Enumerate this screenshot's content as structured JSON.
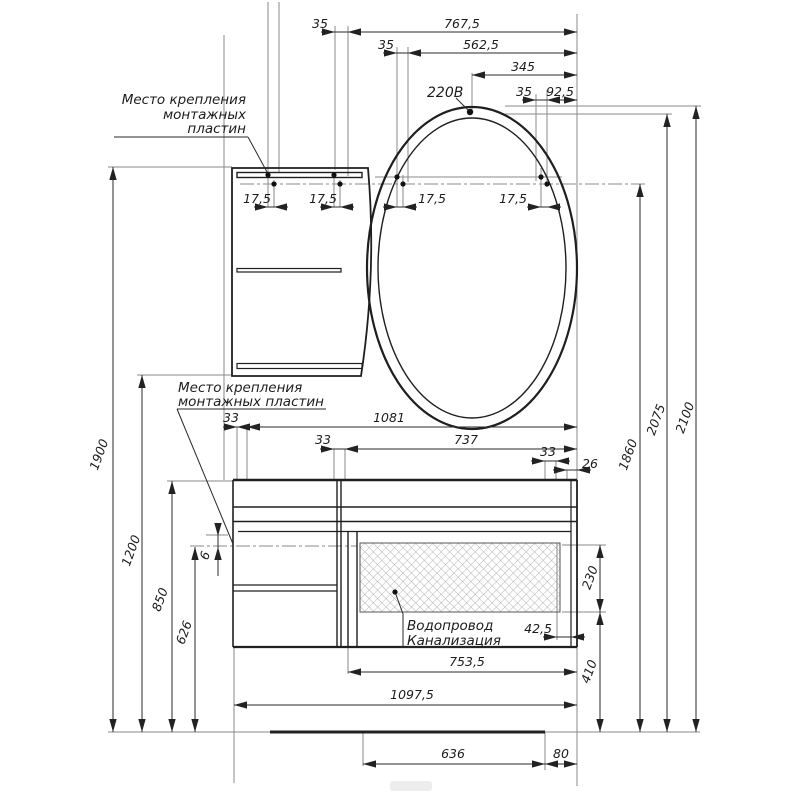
{
  "drawing": {
    "annotations": {
      "mount_top": {
        "line1": "Место крепления",
        "line2": "монтажных",
        "line3": "пластин"
      },
      "mount_mid": {
        "line1": "Место крепления",
        "line2": "монтажных пластин"
      },
      "power": "220В",
      "plumbing": {
        "line1": "Водопровод",
        "line2": "Канализация"
      }
    },
    "dimensions": {
      "top": {
        "d35a": "35",
        "d767": "767,5",
        "d35b": "35",
        "d562": "562,5",
        "d345": "345",
        "d35c": "35",
        "d92": "92,5"
      },
      "mount_offsets": [
        "17,5",
        "17,5",
        "17,5",
        "17,5"
      ],
      "left": {
        "d1900": "1900",
        "d1200": "1200",
        "d850": "850",
        "d626": "626",
        "d6": "6"
      },
      "middle": {
        "d1081": "1081",
        "d737": "737",
        "d33a": "33",
        "d33b": "33",
        "d33c": "33",
        "d26": "26"
      },
      "right": {
        "d1860": "1860",
        "d2075": "2075",
        "d2100": "2100",
        "d230": "230",
        "d42": "42,5",
        "d410": "410"
      },
      "bottom": {
        "d753": "753,5",
        "d1097": "1097,5",
        "d636": "636",
        "d80": "80"
      }
    },
    "colors": {
      "line": "#1f1f1f",
      "extension": "#8a8a8a",
      "background": "#ffffff"
    }
  }
}
